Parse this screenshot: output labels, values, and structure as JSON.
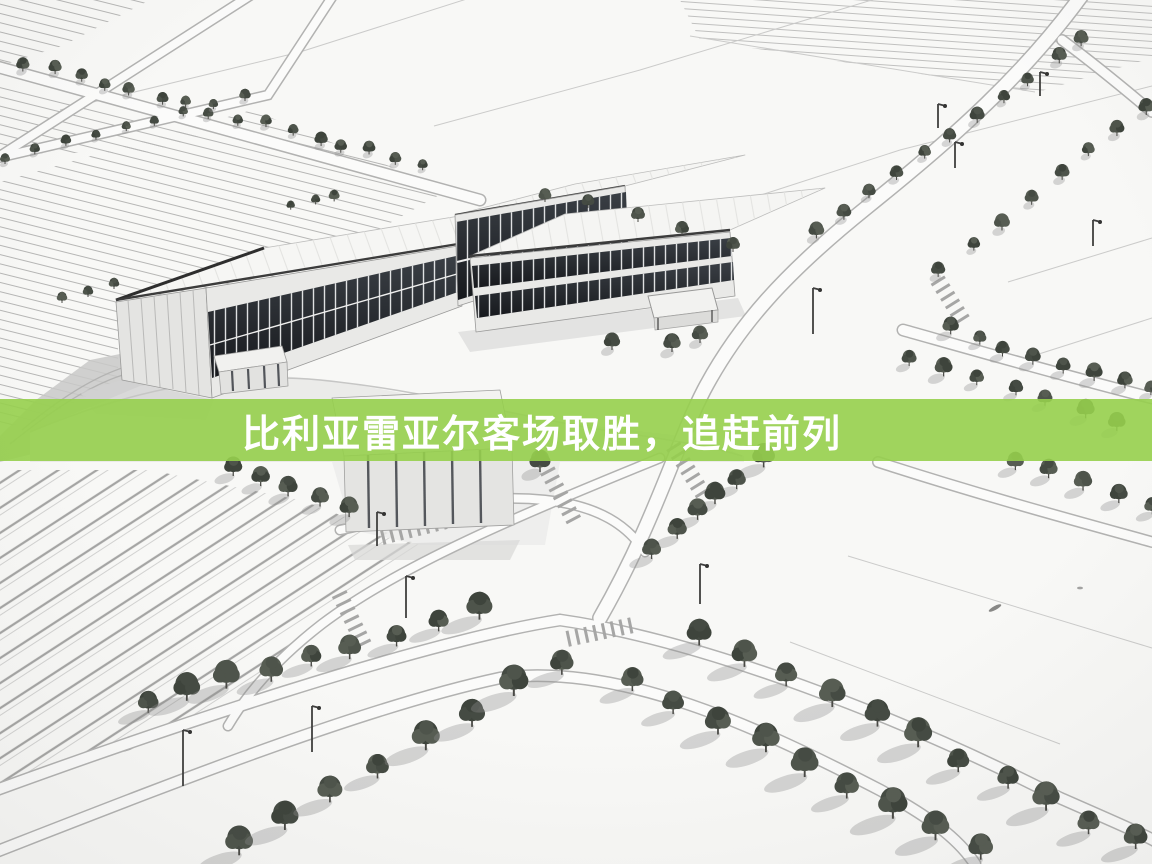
{
  "banner": {
    "headline": "比利亚雷亚尔客场取胜，追赶前列",
    "background_color": "#96CF4C",
    "text_color": "#FFFFFF"
  },
  "illustration": {
    "style_colors": {
      "ground": "#F7F7F5",
      "glass": "#24272B",
      "tree": "#4E544B",
      "road_edge": "#B2B2B2"
    },
    "visible_elements": [
      "white warehouse building with dark glass band",
      "two-storey glass office building",
      "second warehouse with entrance canopy",
      "small annex buildings",
      "tree-lined boulevards",
      "plowed fields",
      "street lamps",
      "crosswalks"
    ]
  }
}
